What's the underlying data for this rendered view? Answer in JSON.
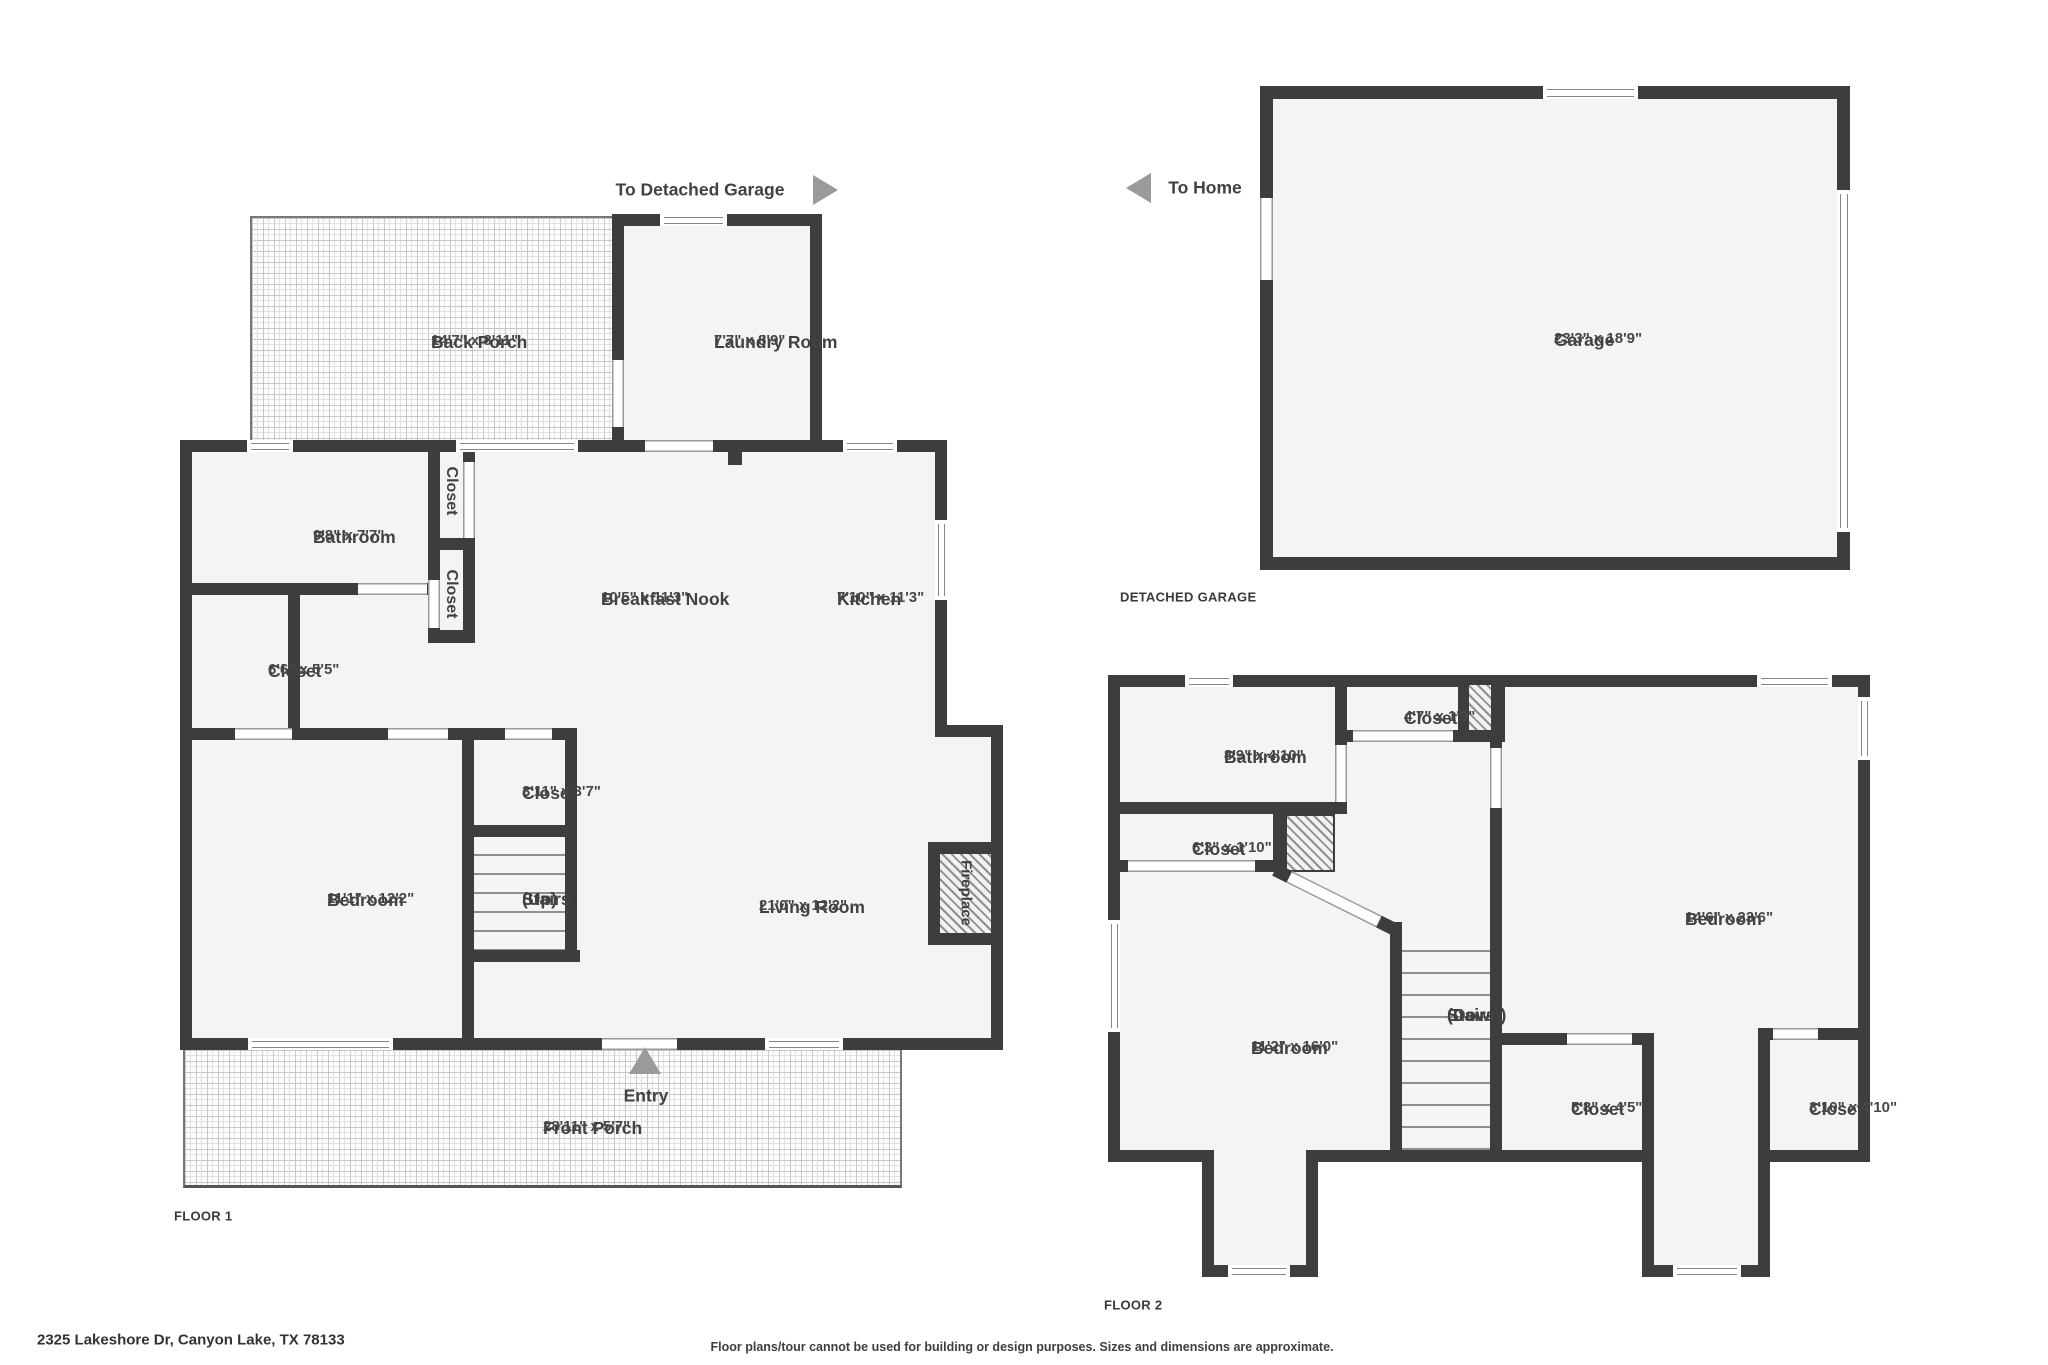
{
  "page": {
    "address": "2325 Lakeshore Dr, Canyon Lake, TX 78133",
    "disclaimer": "Floor plans/tour cannot be used for building or design purposes. Sizes and dimensions are approximate.",
    "floor1_label": "FLOOR 1",
    "floor2_label": "FLOOR 2",
    "detached_garage_label": "DETACHED GARAGE",
    "to_detached_garage": "To Detached Garage",
    "to_home": "To Home",
    "entry": "Entry"
  },
  "colors": {
    "wall": "#3d3d3d",
    "floor": "#f4f4f4",
    "arrow": "#9a9a9a",
    "text": "#414141"
  },
  "floor1": {
    "back_porch": {
      "name": "Back Porch",
      "dims": "14'7\" x 8'11\""
    },
    "laundry": {
      "name": "Laundry Room",
      "dims": "7'7\" x 8'9\""
    },
    "bathroom": {
      "name": "Bathroom",
      "dims": "9'8\" x 7'7\""
    },
    "closet_a": {
      "name": "Closet"
    },
    "closet_b": {
      "name": "Closet"
    },
    "closet_66": {
      "name": "Closet",
      "dims": "6'6\" x 5'5\""
    },
    "breakfast_nook": {
      "name": "Breakfast Nook",
      "dims": "10'5\" x 11'3\""
    },
    "kitchen": {
      "name": "Kitchen",
      "dims": "7'10\" x 11'3\""
    },
    "bedroom": {
      "name": "Bedroom",
      "dims": "11'1\" x 12'2\""
    },
    "closet_311": {
      "name": "Closet",
      "dims": "3'11\" x 3'7\""
    },
    "stairs": {
      "name": "Stairs",
      "dims": "(Up)"
    },
    "living_room": {
      "name": "Living Room",
      "dims": "21'0\" x 12'2\""
    },
    "fireplace": {
      "name": "Fireplace"
    },
    "front_porch": {
      "name": "Front Porch",
      "dims": "28'11\" x 5'7\""
    }
  },
  "garage": {
    "garage": {
      "name": "Garage",
      "dims": "23'3\" x 18'9\""
    }
  },
  "floor2": {
    "bathroom": {
      "name": "Bathroom",
      "dims": "8'9\" x 4'10\""
    },
    "closet_47": {
      "name": "Closet",
      "dims": "4'7\" x 1'9\""
    },
    "closet_63": {
      "name": "Closet",
      "dims": "6'3\" x 1'10\""
    },
    "bedroom_small": {
      "name": "Bedroom",
      "dims": "11'2\" x 16'0\""
    },
    "stairs": {
      "name": "Stairs",
      "dims": "(Down)"
    },
    "bedroom_large": {
      "name": "Bedroom",
      "dims": "14'6\" x 23'6\""
    },
    "closet_58": {
      "name": "Closet",
      "dims": "5'8\" x 4'5\""
    },
    "closet_310": {
      "name": "Closet",
      "dims": "3'10\" x 4'10\""
    }
  }
}
